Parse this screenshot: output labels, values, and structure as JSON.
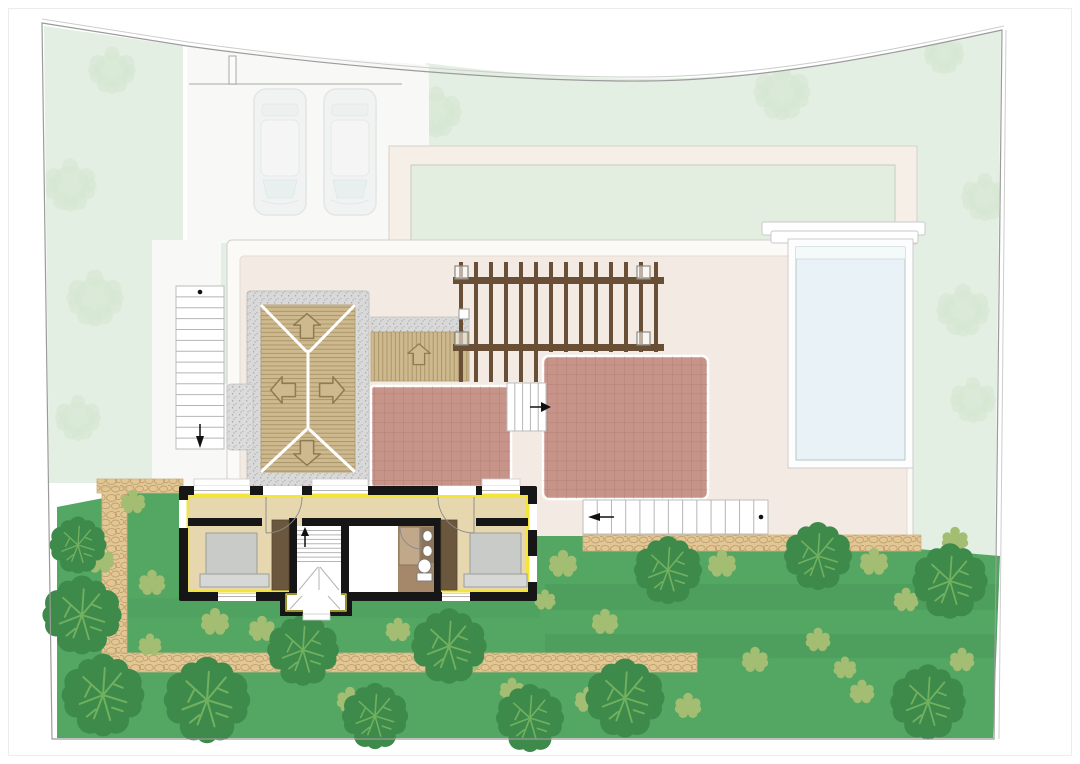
{
  "palette": {
    "paper": "#ffffff",
    "frame": "#ececec",
    "boundary": "#9b9b9b",
    "boundary_outer": "#cdcdcd",
    "garden_pale": "#e4efe3",
    "faint_tree": "#d5e6d3",
    "white_zone": "#f8f8f7",
    "slab": "#fcfaf7",
    "terrace_cream": "#f3ebe3",
    "band_cream": "#f5efe8",
    "planter": "#e3eee1",
    "pool_water": "#e9f2f6",
    "pool_deck": "#fdfdfd",
    "terracotta": "#c7948a",
    "deck_wood": "#cdb98d",
    "gravel": "#d9d9d9",
    "pergola_wood": "#6a4f37",
    "lawn": "#53a763",
    "path_tan": "#e2c795",
    "path_line": "#bfa06b",
    "bush": "#a3bd72",
    "tree": "#3d8a4b",
    "tree_vein": "#71b05e",
    "wall": "#161616",
    "accent": "#f2e438",
    "floor_tan": "#e7d7ae",
    "wardrobe": "#6b573d",
    "bath_floor": "#a5876a",
    "shower": "#c2a88a",
    "counter": "#8f7558",
    "bed": "#c9cbc9",
    "bed_head": "#d6d8d6",
    "stair": "#ffffff",
    "line": "#b5b5b5",
    "arrow_outline": "#8c7c52",
    "car_body": "#edf0f0",
    "car_line": "#d2d8d9",
    "car_glass": "#dce9ea"
  },
  "site": {
    "type": "residential-site-plan",
    "cars_parked": 2,
    "bedrooms": 2,
    "beds": 2,
    "bathroom_sinks": 2,
    "toilets": 1,
    "showers": 1,
    "pools": 1,
    "pergolas": 1,
    "roof_slope_arrows": 5
  },
  "vegetation": {
    "faint_trees_left": [
      {
        "x": 112,
        "y": 70,
        "r": 26
      },
      {
        "x": 70,
        "y": 185,
        "r": 29
      },
      {
        "x": 95,
        "y": 298,
        "r": 31
      },
      {
        "x": 78,
        "y": 418,
        "r": 25
      }
    ],
    "faint_trees_right": [
      {
        "x": 436,
        "y": 112,
        "r": 28
      },
      {
        "x": 782,
        "y": 92,
        "r": 31
      },
      {
        "x": 944,
        "y": 54,
        "r": 22
      },
      {
        "x": 985,
        "y": 197,
        "r": 26
      },
      {
        "x": 963,
        "y": 310,
        "r": 29
      },
      {
        "x": 973,
        "y": 400,
        "r": 25
      }
    ],
    "trees": [
      {
        "x": 78,
        "y": 545,
        "r": 31
      },
      {
        "x": 82,
        "y": 615,
        "r": 43
      },
      {
        "x": 103,
        "y": 695,
        "r": 45
      },
      {
        "x": 207,
        "y": 700,
        "r": 47
      },
      {
        "x": 303,
        "y": 650,
        "r": 39
      },
      {
        "x": 375,
        "y": 716,
        "r": 36
      },
      {
        "x": 449,
        "y": 646,
        "r": 41
      },
      {
        "x": 530,
        "y": 718,
        "r": 37
      },
      {
        "x": 625,
        "y": 698,
        "r": 43
      },
      {
        "x": 668,
        "y": 570,
        "r": 37
      },
      {
        "x": 818,
        "y": 556,
        "r": 37
      },
      {
        "x": 950,
        "y": 581,
        "r": 41
      },
      {
        "x": 928,
        "y": 702,
        "r": 41
      }
    ],
    "bushes": [
      {
        "x": 133,
        "y": 502,
        "r": 14
      },
      {
        "x": 100,
        "y": 560,
        "r": 16
      },
      {
        "x": 152,
        "y": 583,
        "r": 15
      },
      {
        "x": 215,
        "y": 622,
        "r": 16
      },
      {
        "x": 262,
        "y": 629,
        "r": 15
      },
      {
        "x": 150,
        "y": 645,
        "r": 13
      },
      {
        "x": 322,
        "y": 638,
        "r": 15
      },
      {
        "x": 398,
        "y": 630,
        "r": 14
      },
      {
        "x": 470,
        "y": 658,
        "r": 15
      },
      {
        "x": 545,
        "y": 600,
        "r": 12
      },
      {
        "x": 563,
        "y": 564,
        "r": 16
      },
      {
        "x": 605,
        "y": 622,
        "r": 15
      },
      {
        "x": 648,
        "y": 568,
        "r": 13
      },
      {
        "x": 722,
        "y": 564,
        "r": 16
      },
      {
        "x": 755,
        "y": 660,
        "r": 15
      },
      {
        "x": 818,
        "y": 640,
        "r": 14
      },
      {
        "x": 845,
        "y": 668,
        "r": 13
      },
      {
        "x": 874,
        "y": 562,
        "r": 16
      },
      {
        "x": 906,
        "y": 600,
        "r": 14
      },
      {
        "x": 955,
        "y": 540,
        "r": 15
      },
      {
        "x": 962,
        "y": 660,
        "r": 14
      },
      {
        "x": 350,
        "y": 700,
        "r": 15
      },
      {
        "x": 512,
        "y": 690,
        "r": 14
      },
      {
        "x": 588,
        "y": 700,
        "r": 15
      },
      {
        "x": 862,
        "y": 692,
        "r": 14
      },
      {
        "x": 688,
        "y": 706,
        "r": 15
      }
    ]
  },
  "pergola": {
    "x0": 459,
    "step": 15,
    "slat_w": 4,
    "beams": [
      {
        "y": 277
      },
      {
        "y": 344
      }
    ],
    "beam_h": 7,
    "long": {
      "count": 6,
      "y1": 262,
      "y2": 382
    },
    "short": {
      "count": 8,
      "y1": 262,
      "y2": 352
    }
  },
  "stairs": [
    {
      "name": "west-garden-stair",
      "x": 176,
      "y": 286,
      "w": 48,
      "h": 163,
      "treads": 14,
      "dir": "h"
    },
    {
      "name": "terrace-step-stair",
      "x": 507,
      "y": 383,
      "w": 39,
      "h": 48,
      "treads": 4,
      "dir": "v"
    },
    {
      "name": "south-terrace-stair",
      "x": 583,
      "y": 500,
      "w": 185,
      "h": 34,
      "treads": 12,
      "dir": "v"
    },
    {
      "name": "interior-stair-treads",
      "x": 297,
      "y": 526,
      "w": 44,
      "h": 40,
      "treads": 8,
      "dir": "h",
      "noRect": true
    }
  ],
  "cars": [
    {
      "x": 253,
      "y": 88
    },
    {
      "x": 323,
      "y": 88
    }
  ]
}
